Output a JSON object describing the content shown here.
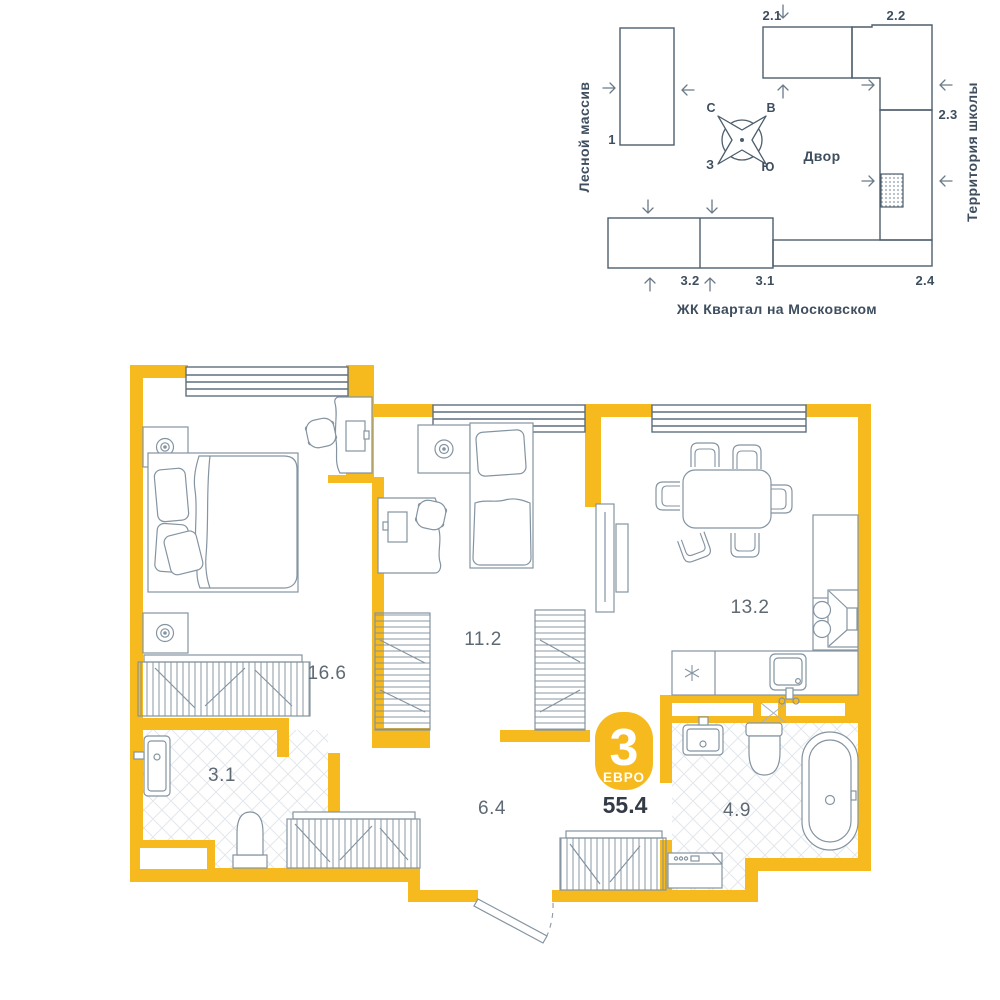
{
  "site_plan": {
    "left_area": "Лесной массив",
    "right_area": "Территория школы",
    "courtyard": "Двор",
    "complex": "ЖК Квартал на Московском",
    "compass": {
      "n": "С",
      "e": "В",
      "w": "З",
      "s": "Ю"
    },
    "buildings": [
      "1",
      "2.1",
      "2.2",
      "2.3",
      "2.4",
      "3.2",
      "3.1"
    ]
  },
  "plan": {
    "badge_rooms": "3",
    "badge_type": "ЕВРО",
    "total_area": "55.4",
    "rooms": [
      {
        "id": "bedroom",
        "area": "16.6"
      },
      {
        "id": "bedroom-2",
        "area": "11.2"
      },
      {
        "id": "kitchen-living",
        "area": "13.2"
      },
      {
        "id": "bathroom",
        "area": "3.1"
      },
      {
        "id": "hallway",
        "area": "6.4"
      },
      {
        "id": "bathroom-2",
        "area": "4.9"
      }
    ]
  },
  "colors": {
    "wall_yellow": "#F6B91E",
    "site_line": "#4D5E6C",
    "furniture_line": "#8494A1",
    "label_gray": "#5E6973",
    "dark_text": "#333B45",
    "tile_line": "#E3E7EB"
  }
}
